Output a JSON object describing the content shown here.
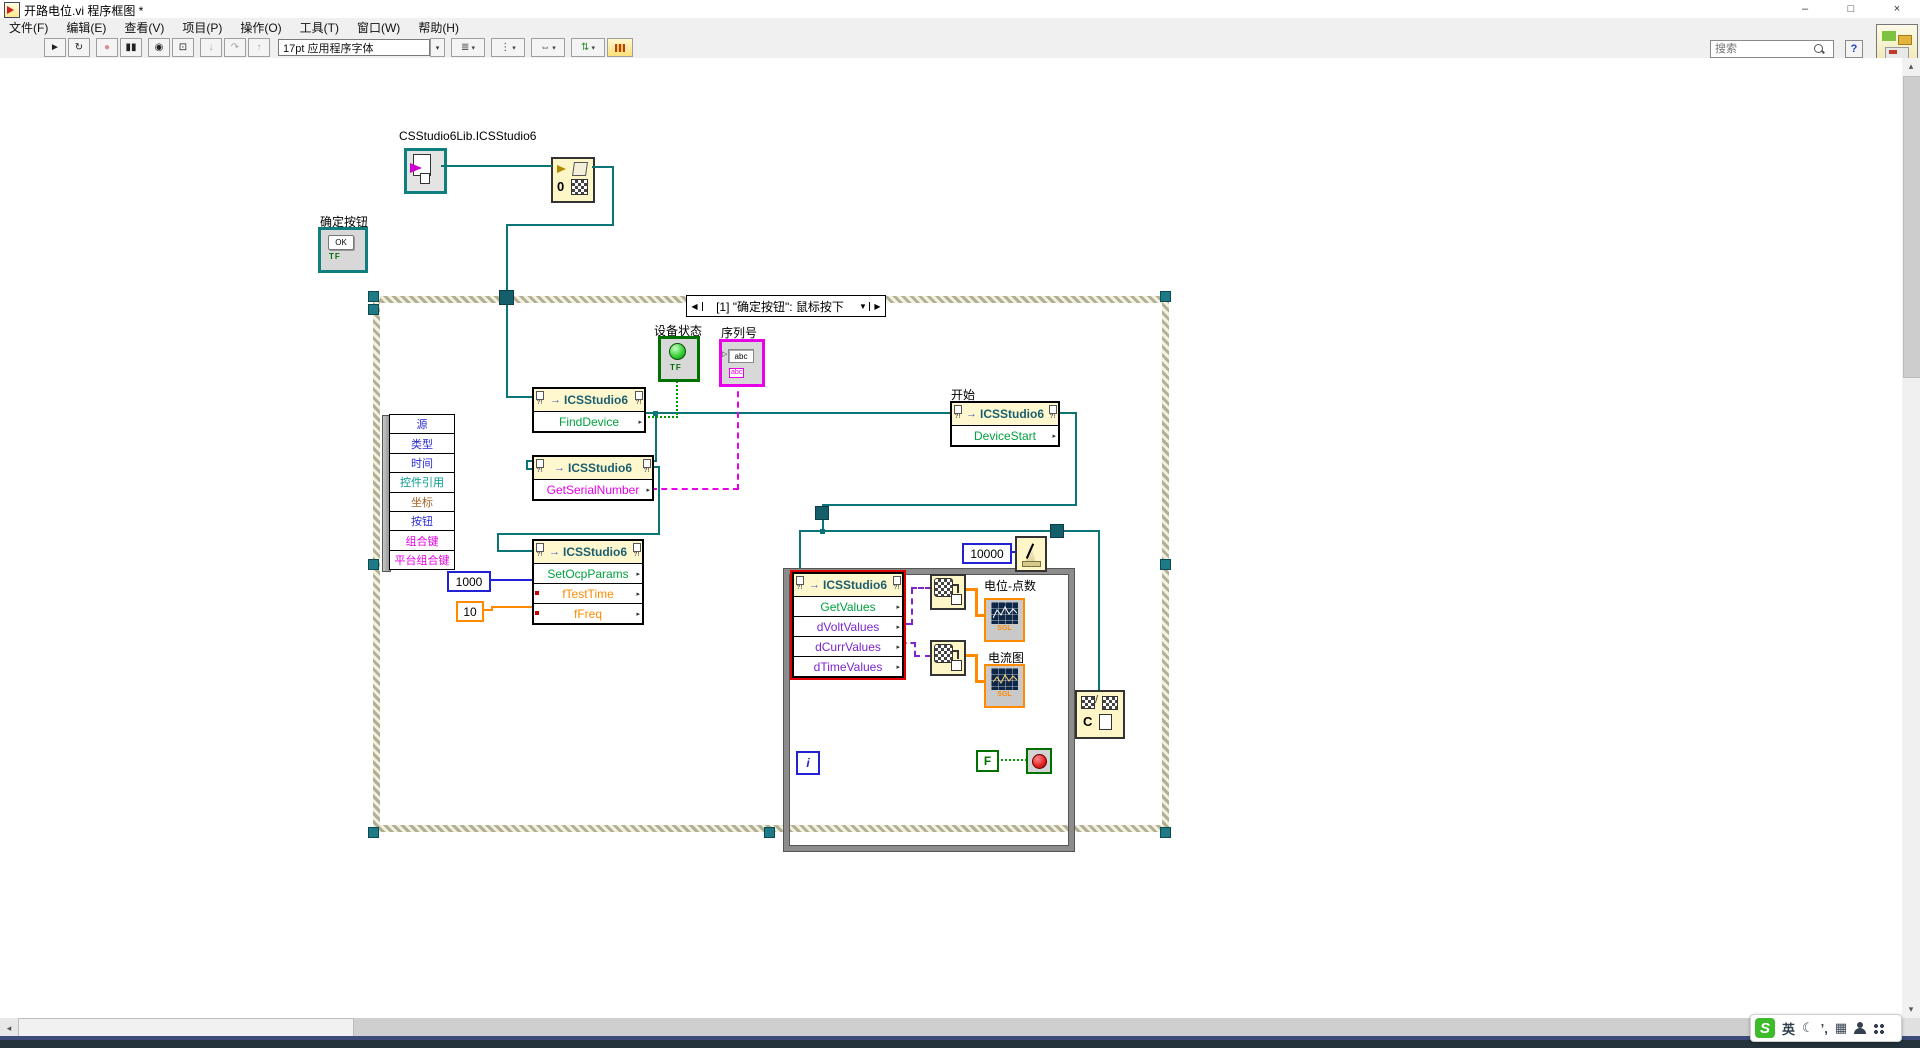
{
  "window": {
    "title": "开路电位.vi 程序框图 *",
    "minimize": "–",
    "maximize": "□",
    "close": "×"
  },
  "menu": [
    "文件(F)",
    "编辑(E)",
    "查看(V)",
    "项目(P)",
    "操作(O)",
    "工具(T)",
    "窗口(W)",
    "帮助(H)"
  ],
  "toolbar": {
    "font": "17pt 应用程序字体",
    "search_placeholder": "搜索",
    "help": "?",
    "run": "►",
    "run_continuous": "↻",
    "abort": "●",
    "pause": "▮▮",
    "highlight": "◉",
    "retain": "⊡",
    "step_into": "↓",
    "step_over": "↷",
    "step_out": "↑",
    "dd": "▾",
    "align_glyph": "≣",
    "distribute_glyph": "⋮",
    "resize_glyph": "⇔",
    "reorder_glyph": "⇅"
  },
  "icons": {
    "invoke_arrow": "→",
    "row_arrow": "▸",
    "corner_marks": "?!",
    "prev": "◀",
    "next": "▶",
    "dropdown": "▼",
    "sb_left": "◂",
    "sb_right": "▸",
    "sb_up": "▴",
    "sb_down": "▾",
    "in_arrow": "▷"
  },
  "diagram": {
    "class_constant_label": "CSStudio6Lib.ICSStudio6",
    "ok_button": {
      "label": "确定按钮",
      "text": "OK",
      "tf": "TF"
    },
    "event_structure": {
      "header": "[1] \"确定按钮\": 鼠标按下",
      "event_data_items": [
        {
          "label": "源",
          "color": "#2B2BD5"
        },
        {
          "label": "类型",
          "color": "#2B2BD5"
        },
        {
          "label": "时间",
          "color": "#2B2BD5"
        },
        {
          "label": "控件引用",
          "color": "#00998F"
        },
        {
          "label": "坐标",
          "color": "#A8622A"
        },
        {
          "label": "按钮",
          "color": "#2B2BD5"
        },
        {
          "label": "组合键",
          "color": "#E800E8"
        },
        {
          "label": "平台组合键",
          "color": "#E800E8"
        }
      ]
    },
    "nodes": {
      "find_device": {
        "class": "ICSStudio6",
        "method": "FindDevice"
      },
      "get_serial": {
        "class": "ICSStudio6",
        "method": "GetSerialNumber"
      },
      "set_ocp": {
        "class": "ICSStudio6",
        "method": "SetOcpParams",
        "param1": "fTestTime",
        "param2": "fFreq"
      },
      "device_start": {
        "label": "开始",
        "class": "ICSStudio6",
        "method": "DeviceStart"
      },
      "get_values": {
        "class": "ICSStudio6",
        "method": "GetValues",
        "out1": "dVoltValues",
        "out2": "dCurrValues",
        "out3": "dTimeValues"
      },
      "close_ref": {
        "letter": "C"
      },
      "constructor_zero": "0"
    },
    "indicators": {
      "device_status": {
        "label": "设备状态",
        "tf": "TF"
      },
      "serial_number": {
        "label": "序列号",
        "value": "abc",
        "tag": "abc"
      },
      "chart_volt": {
        "label": "电位-点数",
        "dtype": "SGL"
      },
      "chart_curr": {
        "label": "电流图",
        "dtype": "SGL"
      }
    },
    "constants": {
      "test_time": "1000",
      "freq": "10",
      "wait_ms": "10000",
      "stop": "F"
    },
    "loop": {
      "iteration": "i"
    },
    "colors": {
      "class_wire": "#0B7575",
      "bool_wire": "#009900",
      "string_wire": "#E800E8",
      "int_wire": "#2121D6",
      "float_wire": "#FF8A00",
      "variant_wire": "#7D26CD",
      "node_header": "#FFF8CE",
      "error_frame": "#E00000"
    }
  },
  "taskbar": {
    "sogou": {
      "logo": "S",
      "mode": "英",
      "moon": "☾",
      "marks": "’,",
      "keyboard": "▦"
    }
  }
}
